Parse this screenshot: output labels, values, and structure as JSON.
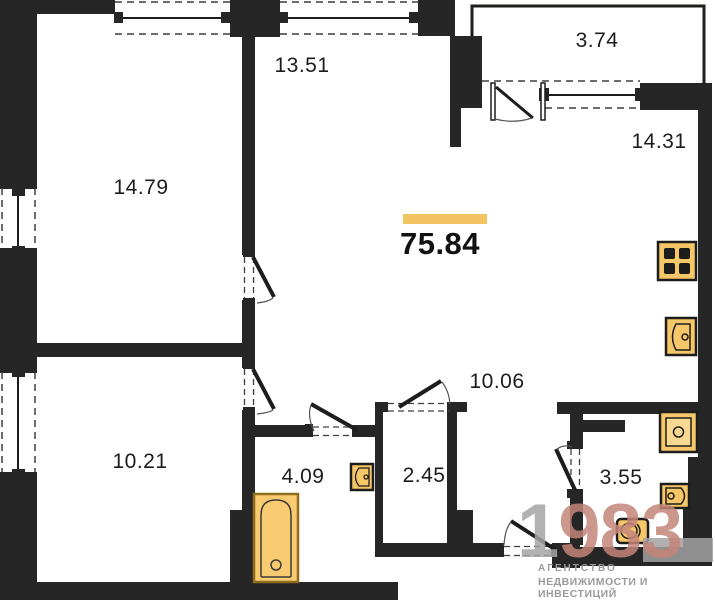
{
  "plan": {
    "total_area_label": "75.84",
    "rooms": [
      {
        "id": "room-14-79",
        "label": "14.79"
      },
      {
        "id": "room-13-51",
        "label": "13.51"
      },
      {
        "id": "balcony",
        "label": "3.74"
      },
      {
        "id": "kitchen-living",
        "label": "14.31"
      },
      {
        "id": "corridor",
        "label": "10.06"
      },
      {
        "id": "room-10-21",
        "label": "10.21"
      },
      {
        "id": "bathroom",
        "label": "4.09"
      },
      {
        "id": "wc",
        "label": "2.45"
      },
      {
        "id": "shower-room",
        "label": "3.55"
      }
    ],
    "fixtures": [
      "stove-icon",
      "kitchen-sink-icon",
      "washing-machine-icon",
      "hand-sink-icon",
      "toilet-icon",
      "corner-sink-icon",
      "bathtub-icon"
    ],
    "colors": {
      "wall": "#262626",
      "accent_bar": "#f2c361",
      "fixture_fill": "#f6c768",
      "bathtub_fill": "#f8cb70"
    }
  },
  "watermark": {
    "number_prefix": "1",
    "number_suffix": "983",
    "line1": "АГЕНТСТВО",
    "line2": "НЕДВИЖИМОСТИ И ИНВЕСТИЦИЙ"
  }
}
